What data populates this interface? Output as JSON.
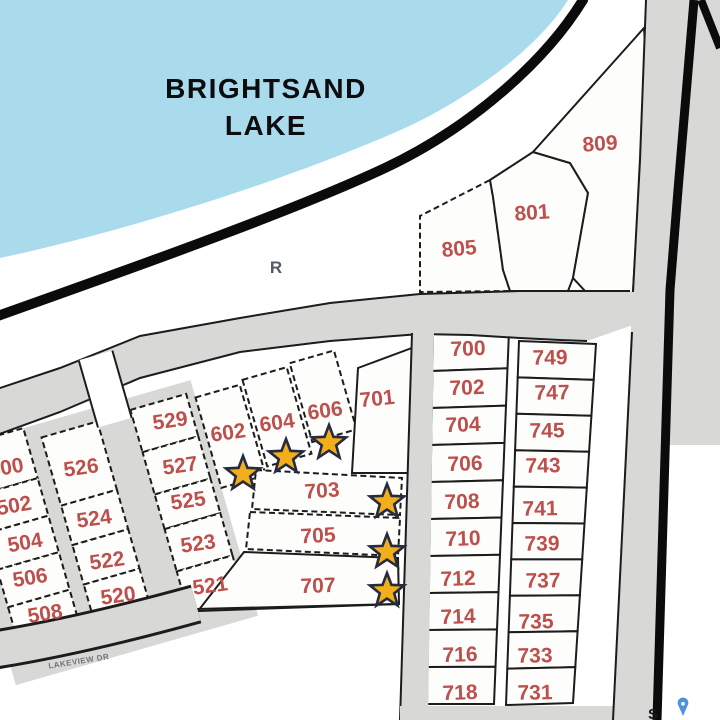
{
  "title": {
    "line1": "BRIGHTSAND",
    "line2": "LAKE"
  },
  "map_labels": {
    "road_letter": "R",
    "street_name": "LAKEVIEW DR",
    "watermark": "S"
  },
  "colors": {
    "lake": "#a9dbec",
    "road_gray": "#d8d8d6",
    "line_black": "#1c1c1c",
    "lot_red": "#bd4f4c",
    "title_color": "#0d0d0f",
    "star_fill": "#f2af1b",
    "star_stroke": "#262b40",
    "pin_blue": "#4d93dc"
  },
  "lots": [
    {
      "label": "500",
      "x": 6,
      "y": 467,
      "r": -10
    },
    {
      "label": "502",
      "x": 14,
      "y": 505,
      "r": -10
    },
    {
      "label": "504",
      "x": 25,
      "y": 542,
      "r": -10
    },
    {
      "label": "506",
      "x": 30,
      "y": 577,
      "r": -9
    },
    {
      "label": "508",
      "x": 45,
      "y": 613,
      "r": -9
    },
    {
      "label": "526",
      "x": 81,
      "y": 467,
      "r": -8
    },
    {
      "label": "524",
      "x": 94,
      "y": 518,
      "r": -8
    },
    {
      "label": "522",
      "x": 107,
      "y": 560,
      "r": -8
    },
    {
      "label": "520",
      "x": 118,
      "y": 595,
      "r": -8
    },
    {
      "label": "529",
      "x": 170,
      "y": 420,
      "r": -8
    },
    {
      "label": "527",
      "x": 180,
      "y": 465,
      "r": -8
    },
    {
      "label": "525",
      "x": 188,
      "y": 500,
      "r": -8
    },
    {
      "label": "523",
      "x": 198,
      "y": 543,
      "r": -8
    },
    {
      "label": "521",
      "x": 210,
      "y": 585,
      "r": -8
    },
    {
      "label": "602",
      "x": 228,
      "y": 432,
      "r": -8
    },
    {
      "label": "604",
      "x": 277,
      "y": 422,
      "r": -8
    },
    {
      "label": "606",
      "x": 325,
      "y": 410,
      "r": -8
    },
    {
      "label": "701",
      "x": 377,
      "y": 398,
      "r": -6
    },
    {
      "label": "703",
      "x": 322,
      "y": 490,
      "r": -4
    },
    {
      "label": "705",
      "x": 318,
      "y": 535,
      "r": -3
    },
    {
      "label": "707",
      "x": 318,
      "y": 585,
      "r": -2
    },
    {
      "label": "805",
      "x": 459,
      "y": 248,
      "r": -5
    },
    {
      "label": "801",
      "x": 532,
      "y": 212,
      "r": -4
    },
    {
      "label": "809",
      "x": 600,
      "y": 143,
      "r": -4
    },
    {
      "label": "700",
      "x": 468,
      "y": 348,
      "r": -2
    },
    {
      "label": "702",
      "x": 467,
      "y": 387,
      "r": -2
    },
    {
      "label": "704",
      "x": 463,
      "y": 424,
      "r": -2
    },
    {
      "label": "706",
      "x": 465,
      "y": 463,
      "r": -2
    },
    {
      "label": "708",
      "x": 462,
      "y": 501,
      "r": -2
    },
    {
      "label": "710",
      "x": 463,
      "y": 538,
      "r": -2
    },
    {
      "label": "712",
      "x": 458,
      "y": 578,
      "r": -2
    },
    {
      "label": "714",
      "x": 458,
      "y": 616,
      "r": -2
    },
    {
      "label": "716",
      "x": 460,
      "y": 654,
      "r": -2
    },
    {
      "label": "718",
      "x": 460,
      "y": 692,
      "r": -2
    },
    {
      "label": "749",
      "x": 550,
      "y": 357,
      "r": -1
    },
    {
      "label": "747",
      "x": 552,
      "y": 392,
      "r": -1
    },
    {
      "label": "745",
      "x": 547,
      "y": 430,
      "r": -1
    },
    {
      "label": "743",
      "x": 543,
      "y": 465,
      "r": -1
    },
    {
      "label": "741",
      "x": 540,
      "y": 508,
      "r": -1
    },
    {
      "label": "739",
      "x": 542,
      "y": 543,
      "r": -1
    },
    {
      "label": "737",
      "x": 543,
      "y": 580,
      "r": -1
    },
    {
      "label": "735",
      "x": 536,
      "y": 621,
      "r": -1
    },
    {
      "label": "733",
      "x": 535,
      "y": 655,
      "r": -1
    },
    {
      "label": "731",
      "x": 535,
      "y": 692,
      "r": -1
    }
  ],
  "stars": [
    {
      "x": 243,
      "y": 474
    },
    {
      "x": 286,
      "y": 457
    },
    {
      "x": 329,
      "y": 443
    },
    {
      "x": 387,
      "y": 502
    },
    {
      "x": 387,
      "y": 552
    },
    {
      "x": 387,
      "y": 591
    }
  ]
}
